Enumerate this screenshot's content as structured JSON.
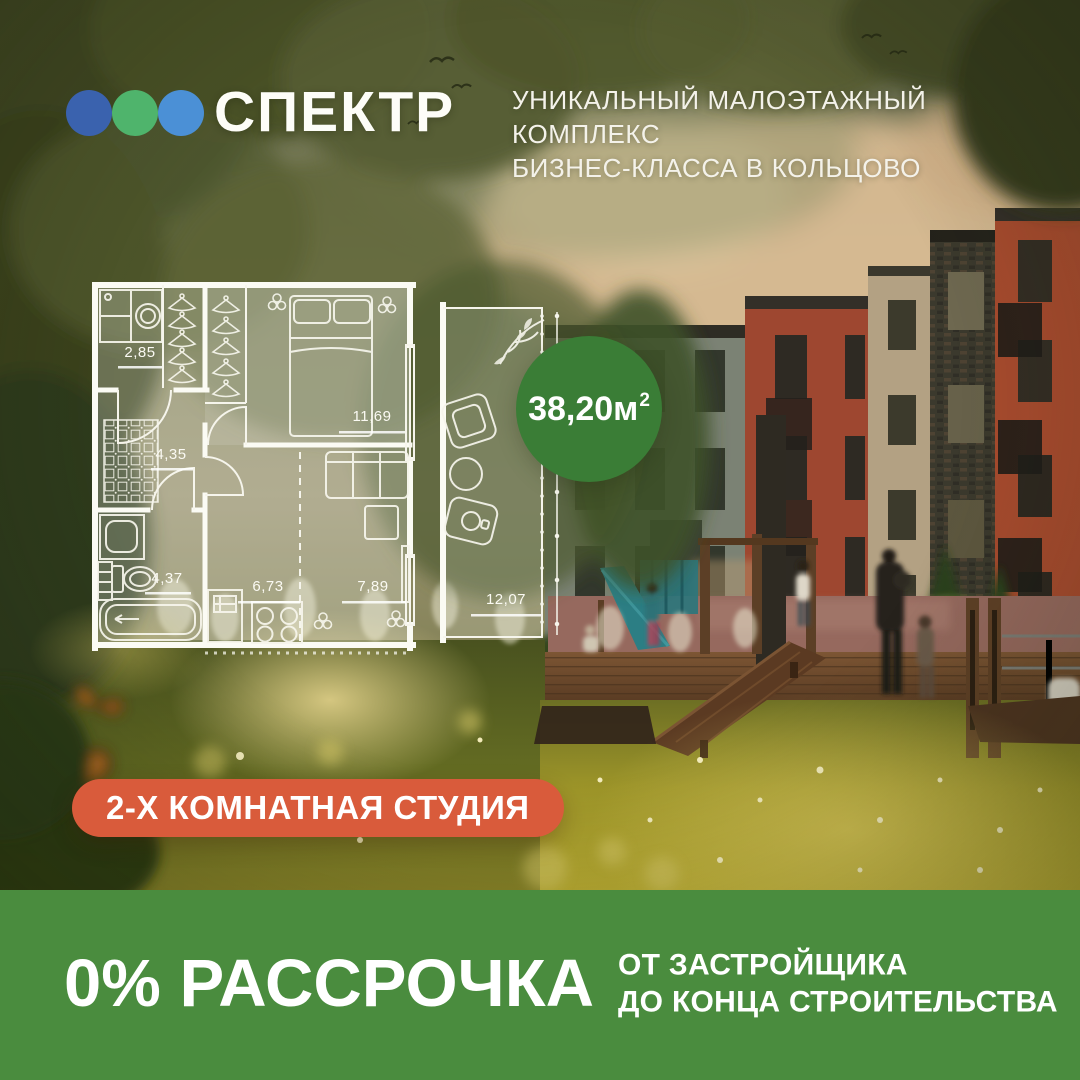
{
  "brand": {
    "logo_text": "СПЕКТР",
    "dot_colors": [
      "#3a62ae",
      "#4fb46c",
      "#4b90d6"
    ]
  },
  "header": {
    "tagline_line1": "УНИКАЛЬНЫЙ МАЛОЭТАЖНЫЙ КОМПЛЕКС",
    "tagline_line2": "БИЗНЕС-КЛАССА В КОЛЬЦОВО"
  },
  "floorplan": {
    "total_area": "38,20м",
    "total_area_sup": "2",
    "rooms": {
      "dressing": "2,85",
      "bedroom": "11,69",
      "hallway": "4,35",
      "bathroom": "4,37",
      "kitchen": "6,73",
      "living": "7,89",
      "terrace": "12,07"
    }
  },
  "apartment_badge": "2-Х КОМНАТНАЯ СТУДИЯ",
  "offer": {
    "headline": "0% РАССРОЧКА",
    "subline1": "ОТ ЗАСТРОЙЩИКА",
    "subline2": "ДО КОНЦА СТРОИТЕЛЬСТВА"
  },
  "colors": {
    "badge_green": "#3a7d36",
    "band_green": "#4a8c3e",
    "accent_orange": "#d95b3b"
  }
}
